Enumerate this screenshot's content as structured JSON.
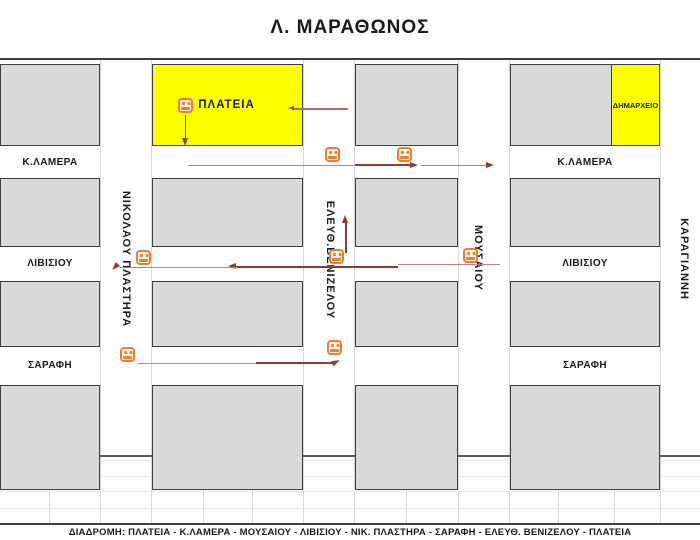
{
  "title": "Λ. ΜΑΡΑΘΩΝΟΣ",
  "footer": "ΔΙΑΔΡΟΜΗ: ΠΛΑΤΕΙΑ - Κ.ΛΑΜΕΡΑ - ΜΟΥΣΑΙΟΥ - ΛΙΒΙΣΙΟΥ - ΝΙΚ. ΠΛΑΣΤΗΡΑ - ΣΑΡΑΦΗ - ΕΛΕΥΘ. ΒΕΝΙΖΕΛΟΥ - ΠΛΑΤΕΙΑ",
  "landmarks": {
    "plateia": "ΠΛΑΤΕΙΑ",
    "dimarxeio": "ΔΗΜΑΡΧΕΙΟ"
  },
  "streets": {
    "kalamera": "Κ.ΛΑΜΕΡΑ",
    "livisiou": "ΛΙΒΙΣΙΟΥ",
    "sarafi": "ΣΑΡΑΦΗ",
    "plastira": "ΝΙΚΟΛΑΟΥ ΠΛΑΣΤΗΡΑ",
    "venizelou": "ΕΛΕΥΘ.ΒΕΝΙΖΕΛΟΥ",
    "mousaiou": "ΜΟΥΣΑΙΟΥ",
    "karagianni": "ΚΑΡΑΓΙΑΝΝΗ"
  },
  "colors": {
    "block_fill": "#d9d9d9",
    "block_border": "#3f3f3f",
    "landmark_fill": "#ffff00",
    "route_line": "#953735",
    "bus_icon": "#ed7d31"
  }
}
